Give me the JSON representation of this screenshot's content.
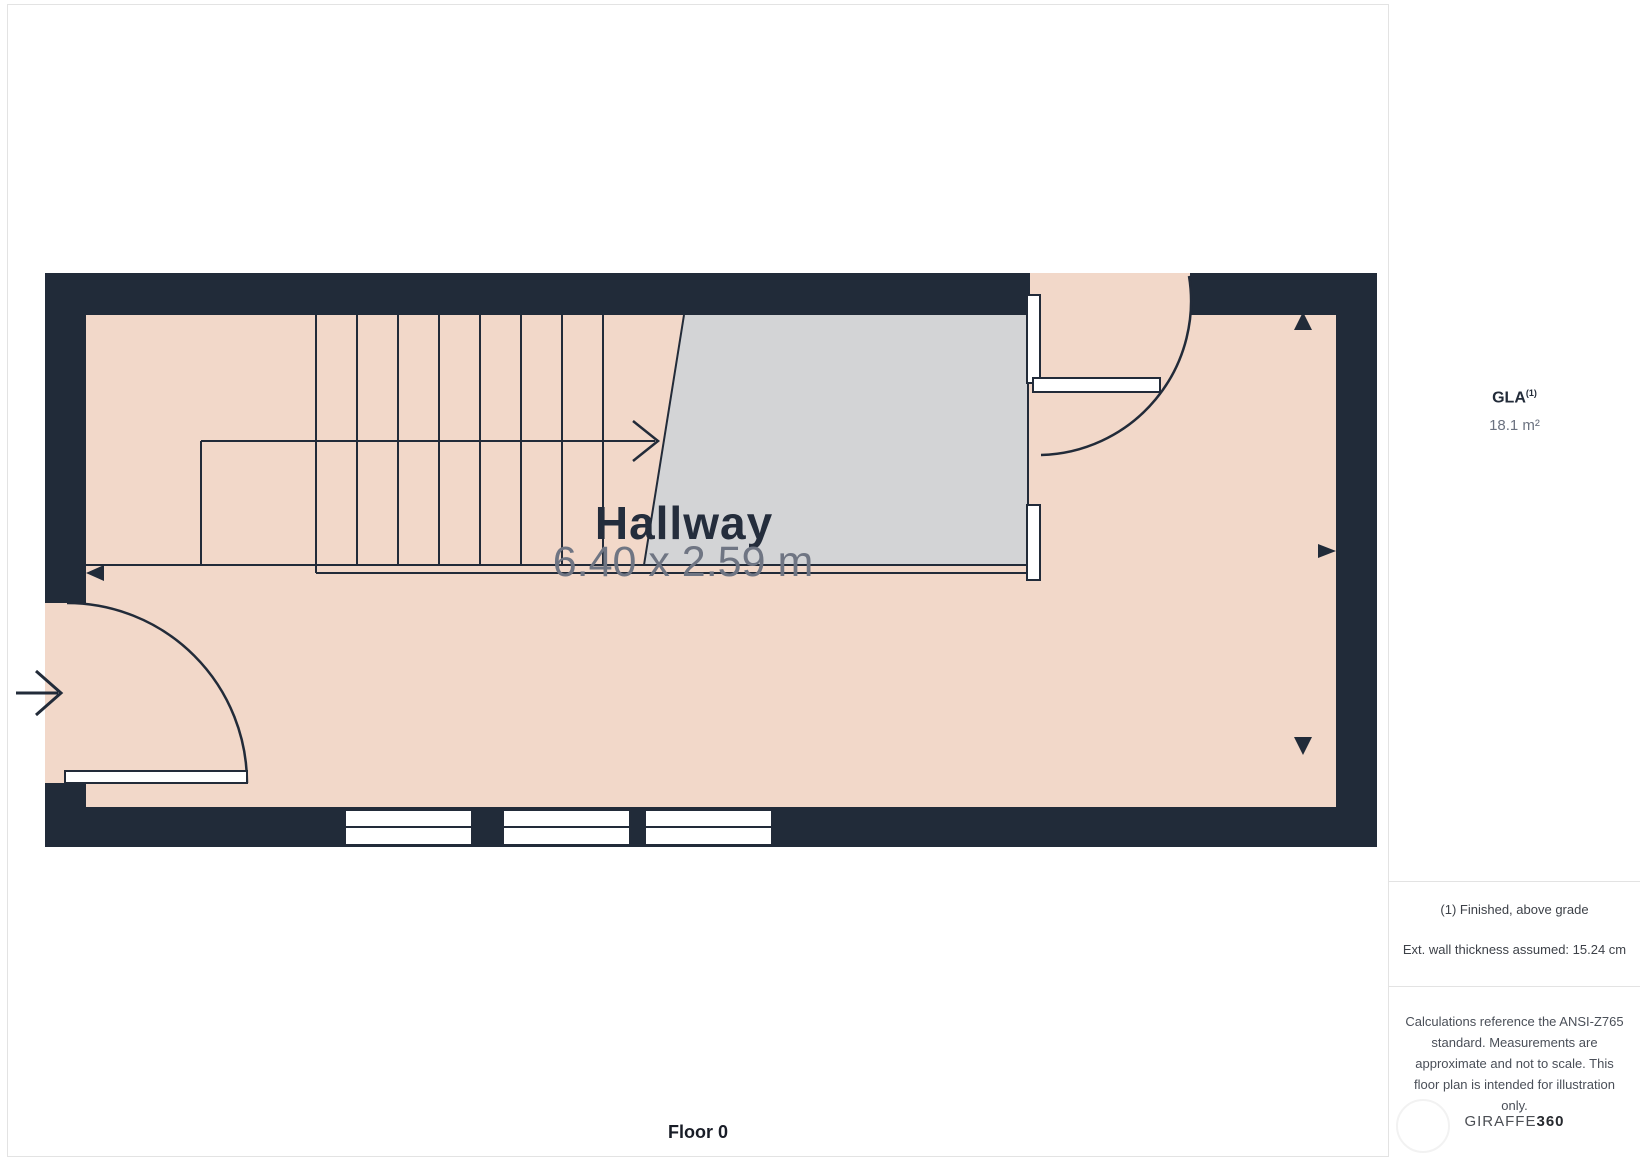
{
  "floor_plan": {
    "room": {
      "name": "Hallway",
      "dimensions": "6.40 x 2.59 m"
    },
    "floor_label": "Floor 0",
    "colors": {
      "wall": "#212b39",
      "floor": "#f2d8c9",
      "stairwell": "#d3d4d6",
      "line": "#222b39",
      "window": "#ffffff"
    }
  },
  "sidebar": {
    "gla": {
      "label": "GLA",
      "superscript": "(1)",
      "value": "18.1 m²"
    },
    "notes": {
      "note1": "(1) Finished, above grade",
      "note2": "Ext. wall thickness assumed: 15.24 cm"
    },
    "disclaimer_lines": [
      "Calculations reference the ANSI-Z765",
      "standard. Measurements are",
      "approximate and not to scale. This",
      "floor plan is intended for illustration",
      "only."
    ],
    "brand": {
      "name_prefix": "GIRAFFE",
      "name_suffix": "360"
    }
  }
}
